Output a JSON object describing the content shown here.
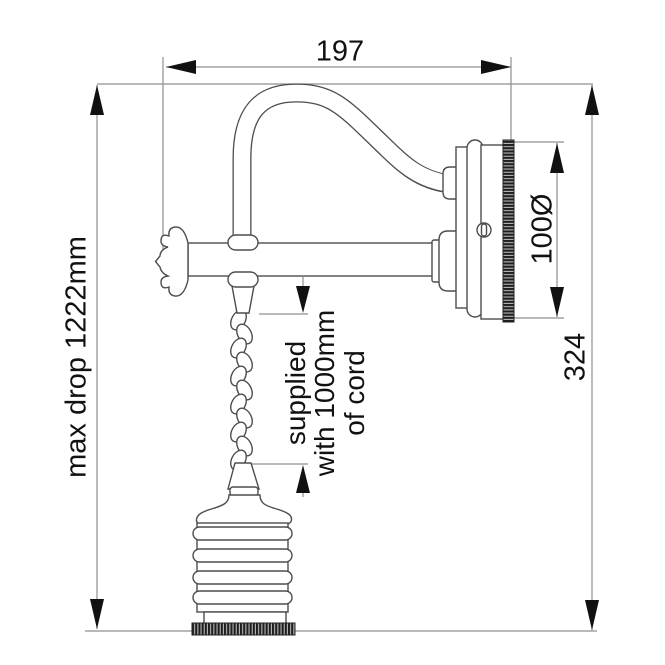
{
  "colors": {
    "background": "#ffffff",
    "line": "#4d4d4d",
    "dim_line": "#8f8f8f",
    "text": "#111111"
  },
  "drawing": {
    "subject": "wall light with hanging pendant cord - dimensioned side elevation",
    "labels": {
      "projection_width": "197",
      "max_drop": "max drop 1222mm",
      "backplate_diameter": "100Ø",
      "wall_plate_height": "324",
      "cord_note": [
        "supplied",
        "with 1000mm",
        "of cord"
      ]
    }
  }
}
